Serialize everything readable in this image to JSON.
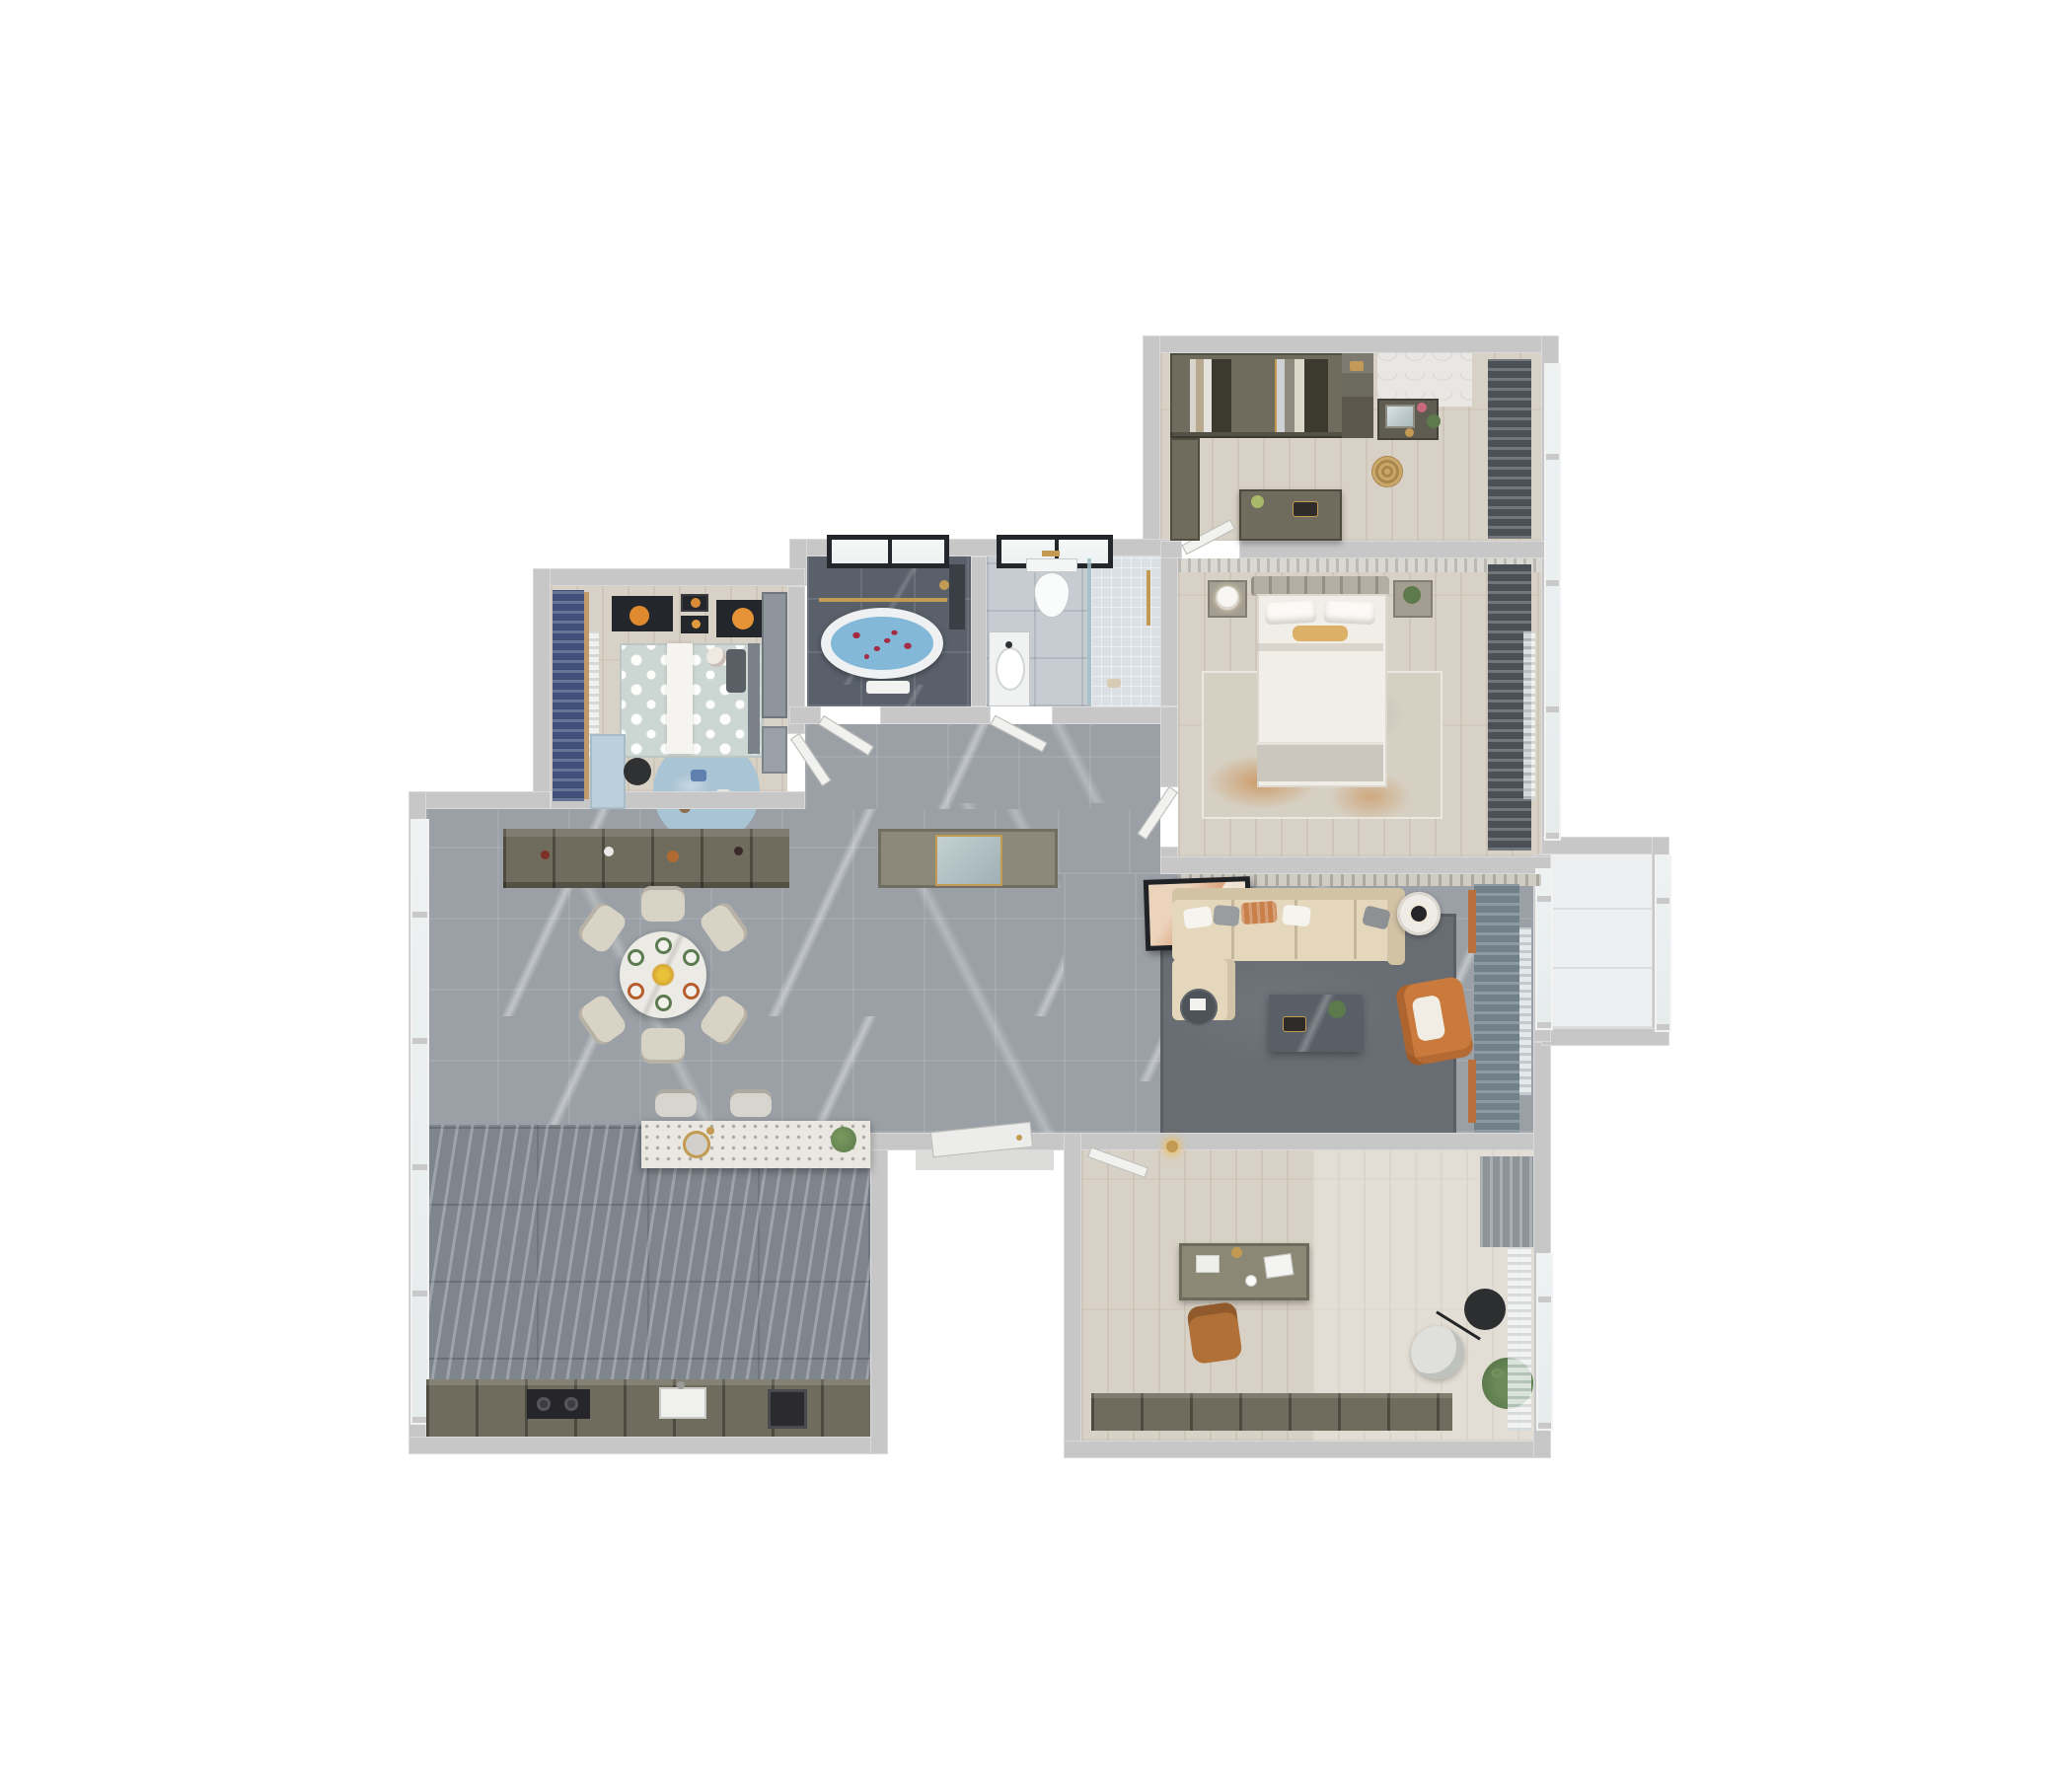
{
  "scene": {
    "title": "3D top-down dollhouse render of a furnished apartment floor plan",
    "view": "orthographic top view, white background, no visible text"
  },
  "palette": {
    "bg": "#ffffff",
    "wall": "#c7c7c7",
    "marble": "#9aa0a6",
    "wood": "#d8d1c5",
    "kitchen": "#7e858d",
    "bathdark": "#59606a",
    "bathlight": "#c7ccd2",
    "shower": "#dbe0e4",
    "balcony": "#edeff0",
    "navy": "#41507a",
    "darkcurt": "#4b5056",
    "teal": "#70818a",
    "sofa": "#e4d7bc",
    "sofaedge": "#d2c3a5",
    "ruglive": "#676d73",
    "rugbed": "#d6d0c3",
    "rugkids": "#a9c4d4",
    "orange": "#c97a3c",
    "olive": "#6f6c5d",
    "olivedark": "#57544a",
    "gold": "#c29a52",
    "framedark": "#23262a",
    "water": "#84b8d8",
    "petal": "#a32c42",
    "terrazzo": "#e9e7e0",
    "mirror": "#b6c5c8",
    "plant": "#5c7a4c",
    "chaircream": "#d9d3c6"
  },
  "rooms": [
    {
      "id": "walk-in-closet",
      "name": "Walk-in closet / dressing room",
      "floor": "light wood",
      "items": [
        "olive wardrobe wall with open hanging sections",
        "open shelf column",
        "vanity console with mirror and plants",
        "island dresser with accessories",
        "rattan basket",
        "dark gray curtains with window"
      ]
    },
    {
      "id": "master-bedroom",
      "name": "Master bedroom",
      "floor": "light wood",
      "items": [
        "double bed with white duvet and orange lumbar pillow",
        "slatted headboard wall",
        "two nightstands",
        "white table lamp",
        "potted plant",
        "distressed white-orange area rug",
        "dark curtains with sheer and windows"
      ]
    },
    {
      "id": "master-bathroom",
      "name": "Master bathroom",
      "floor": "dark gray marble tile",
      "items": [
        "freestanding oval bathtub with blue water and rose petals",
        "gold towel rail",
        "shower column",
        "black framed window",
        "towel"
      ]
    },
    {
      "id": "guest-bathroom",
      "name": "Guest bathroom",
      "floor": "light gray tile",
      "items": [
        "wall-hung toilet",
        "vanity with oval sink",
        "walk-in shower with mosaic floor and glass screen",
        "gold fixtures",
        "black framed window"
      ]
    },
    {
      "id": "kids-bedroom",
      "name": "Kids bedroom",
      "floor": "light wood",
      "items": [
        "bed with polka-dot bedding and white runner",
        "teddy bear",
        "gallery of orange planet artworks",
        "navy curtains over window",
        "light blue desk and black chair",
        "round light-blue play rug with toys",
        "wardrobe and shelving"
      ]
    },
    {
      "id": "hallway-foyer",
      "name": "Hallway and entry foyer",
      "floor": "gray marble tile",
      "items": [
        "entry wardrobe with mirror niche",
        "wine display cabinet",
        "interior doors",
        "entrance door with threshold"
      ]
    },
    {
      "id": "dining-room",
      "name": "Dining room",
      "floor": "gray marble tile",
      "items": [
        "round marble dining table",
        "six cream chairs",
        "six set plates with food",
        "yellow flower centerpiece",
        "floor-to-ceiling windows"
      ]
    },
    {
      "id": "kitchen",
      "name": "Kitchen",
      "floor": "dark striped tile",
      "items": [
        "terrazzo island with round sink and gold tap",
        "potted plant on island",
        "two bar stools",
        "base cabinets with cooktop and sink",
        "tall windows"
      ]
    },
    {
      "id": "living-room",
      "name": "Living room",
      "floor": "gray marble tile",
      "items": [
        "cream sectional sofa with chaise",
        "throw pillows white gray and orange",
        "leaning framed artwork",
        "dark marble coffee table with plant",
        "round side table",
        "orange accent armchair",
        "white drum side table with black lamp",
        "large gray area rug",
        "teal curtains with orange rod accents",
        "gold wall sconce"
      ]
    },
    {
      "id": "study",
      "name": "Study / home office",
      "floor": "light wood",
      "items": [
        "desk with laptop, papers and lamp",
        "tan leather office chair",
        "round lounge chair",
        "black disc floor lamp",
        "potted plant",
        "low olive cabinet",
        "gray curtain and sheer with window"
      ]
    },
    {
      "id": "balcony",
      "name": "Balcony",
      "floor": "pale tile",
      "items": [
        "full-height glazing with mullions"
      ]
    }
  ],
  "annotations": {
    "doors": [
      "entrance door",
      "kids bedroom door",
      "master bathroom door",
      "guest bathroom door",
      "master bedroom door",
      "dressing room door",
      "study door"
    ],
    "openings": [
      "dining to kitchen open plan",
      "hallway to living room open plan",
      "living room to balcony glazed wall"
    ]
  }
}
